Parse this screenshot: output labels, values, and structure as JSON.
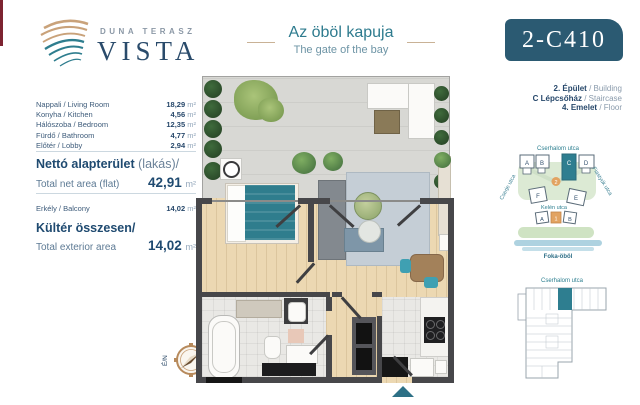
{
  "brand": {
    "name_top": "DUNA TERASZ",
    "name_main": "VISTA"
  },
  "header": {
    "title_hu": "Az öböl kapuja",
    "title_en": "The gate of the bay",
    "unit_code": "2-C410",
    "building_info": [
      {
        "name": "2. Épület",
        "type": "/ Building"
      },
      {
        "name": "C Lépcsőház",
        "type": "/ Staircase"
      },
      {
        "name": "4. Emelet",
        "type": "/ Floor"
      }
    ]
  },
  "left_panel": {
    "rooms": [
      {
        "label": "Nappali / Living Room",
        "value": "18,29",
        "unit": "m²"
      },
      {
        "label": "Konyha / Kitchen",
        "value": "4,56",
        "unit": "m²"
      },
      {
        "label": "Hálószoba / Bedroom",
        "value": "12,35",
        "unit": "m²"
      },
      {
        "label": "Fürdő / Bathroom",
        "value": "4,77",
        "unit": "m²"
      },
      {
        "label": "Előtér / Lobby",
        "value": "2,94",
        "unit": "m²"
      }
    ],
    "net": {
      "title_bold": "Nettó alapterület",
      "title_rest": "(lakás)/",
      "subtitle": "Total net area (flat)",
      "value": "42,91",
      "unit": "m²"
    },
    "balcony": {
      "label": "Erkély / Balcony",
      "value": "14,02",
      "unit": "m²"
    },
    "exterior": {
      "title": "Kültér összesen/",
      "subtitle": "Total exterior area",
      "value": "14,02",
      "unit": "m²"
    }
  },
  "floor_plan": {
    "compass_north": "É/N"
  },
  "site_map": {
    "street_top": "Cserhalom utca",
    "street_left": "Cserje utca",
    "street_right": "Fiastyúk utca",
    "street_center": "Kelén utca",
    "bay": "Foka-öböl",
    "blocks_top": [
      "A",
      "B",
      "C",
      "D"
    ],
    "blocks_mid": [
      "F",
      "E"
    ],
    "blocks_bottom": [
      "A",
      "1",
      "B"
    ],
    "phase_badge": "2",
    "highlighted_block": "C"
  },
  "key_plan": {
    "street": "Cserhalom utca"
  },
  "colors": {
    "accent_teal": "#2e7b8e",
    "badge_bg": "#2b5a72",
    "navy": "#27486b",
    "orange": "#e2a361",
    "wood": "#ecd8b2",
    "wall": "#47474a"
  }
}
